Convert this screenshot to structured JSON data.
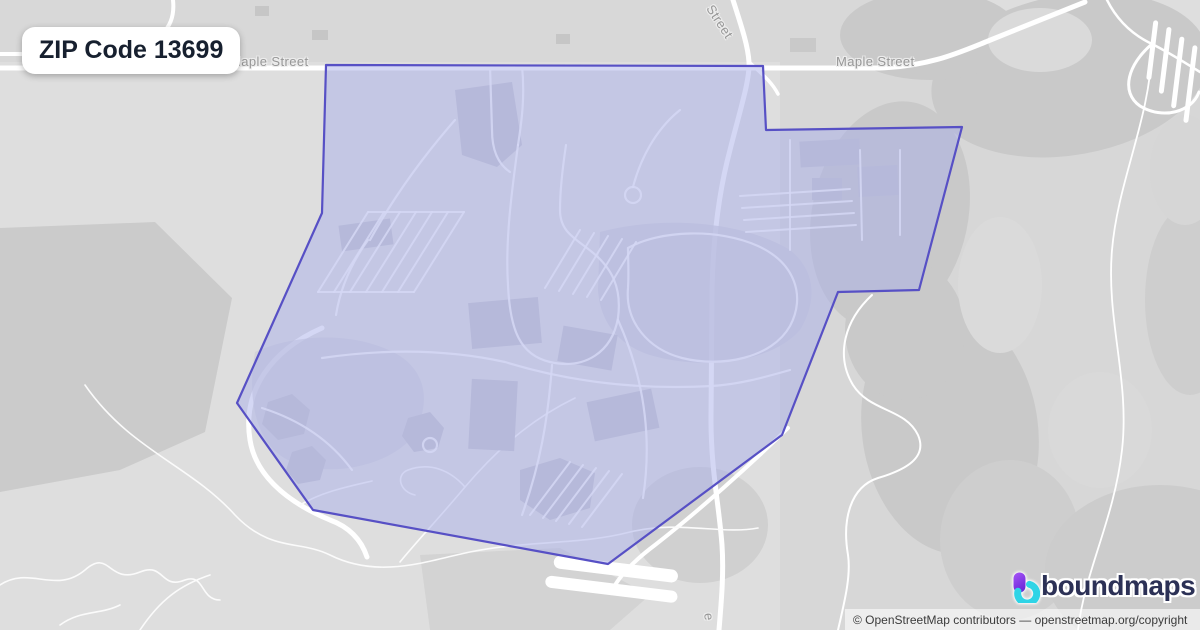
{
  "map": {
    "zip_label": "ZIP Code 13699",
    "street_labels": {
      "maple_left": "Maple Street",
      "maple_right": "Maple Street",
      "street_top": "Street",
      "street_bottom_fragment": "e"
    },
    "boundary_points": "326,65 763,66 766,130 962,127 919,290 838,292 782,435 608,564 313,510 237,403 322,213",
    "colors": {
      "base": "#dedede",
      "forest_dark": "#c9c9c9",
      "forest_mid": "#d7d7d7",
      "road_white": "#ffffff",
      "boundary_fill": "#aab0ea",
      "boundary_stroke": "#5750c5"
    }
  },
  "branding": {
    "logo_text": "boundmaps",
    "logo_text_color": "#2c3156",
    "logo_gradient_start": "#a855f7",
    "logo_gradient_end": "#6d28d9",
    "logo_accent": "#2fd4e6"
  },
  "attribution": {
    "text": "© OpenStreetMap contributors — openstreetmap.org/copyright"
  }
}
